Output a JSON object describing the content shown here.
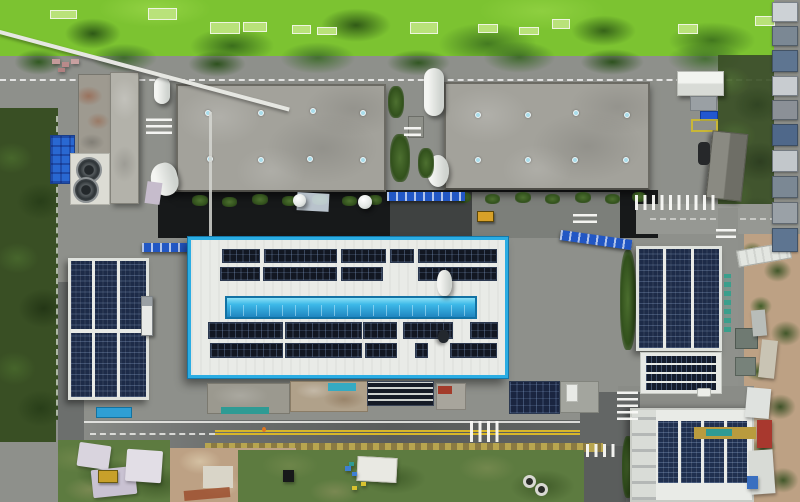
{
  "scene": {
    "type": "aerial-drone-photograph",
    "description": "Top-down aerial view of an industrial plant: two large gray warehouse roofs with blue skylight dots, a white factory hall outlined in bright cyan with a long blue skylight strip and rooftop solar arrays, three additional buildings fully covered in dark-blue solar panels, internal roads with zebra crossings and a yellow-lined perimeter road, a bright green algae pond strip along the top, dark scrub on the left edge, tan dirt lots and a weedy vacant lot along the bottom, and a column of small container buildings on the right edge",
    "time_of_day": "daytime, sunny"
  },
  "palette": {
    "asphalt": "#8e908b",
    "road_dark": "#5d605f",
    "shadow_band": "#17191a",
    "algae": "#7cc331",
    "algae_dark": "#2e571c",
    "algae_light": "#9ad84a",
    "tree": "#3c6526",
    "scrub": "#394f24",
    "warehouse_roof": "#a3a29b",
    "warehouse_edge": "#6b6a63",
    "white_roof": "#e9ebe7",
    "cyan_border": "#2bade3",
    "skylight_blue": "#a9ddeb",
    "strip_deep": "#1f85c0",
    "panel_dark": "#121722",
    "panel_blue": "#1d2b48",
    "dirt": "#bda184",
    "dirt_light": "#d8c6a8",
    "clay": "#9c4f2e",
    "lot_green": "#5d7b40",
    "yellow_line": "#d7b62a",
    "blue_tarp": "#2968d2",
    "rack_blue": "#2257c4",
    "teal": "#2f9b94"
  },
  "counts": {
    "large_warehouses": 2,
    "solar_covered_buildings": 4,
    "zebra_crossings": 8,
    "cooling_fans": 2,
    "warehouse_skylights_each": 8
  },
  "warehouse1": {
    "skylights": [
      [
        27,
        24
      ],
      [
        80,
        24
      ],
      [
        132,
        22
      ],
      [
        182,
        24
      ],
      [
        29,
        70
      ],
      [
        80,
        71
      ],
      [
        129,
        70
      ],
      [
        182,
        71
      ]
    ]
  },
  "warehouse2": {
    "skylights": [
      [
        29,
        28
      ],
      [
        79,
        28
      ],
      [
        127,
        26
      ],
      [
        178,
        28
      ],
      [
        29,
        73
      ],
      [
        79,
        73
      ],
      [
        126,
        73
      ],
      [
        177,
        73
      ]
    ]
  },
  "main_building": {
    "solar_groups": [
      [
        222,
        249,
        38,
        14
      ],
      [
        264,
        249,
        73,
        14
      ],
      [
        341,
        249,
        45,
        14
      ],
      [
        390,
        249,
        24,
        14
      ],
      [
        418,
        249,
        79,
        14
      ],
      [
        220,
        267,
        40,
        14
      ],
      [
        263,
        267,
        74,
        14
      ],
      [
        341,
        267,
        42,
        14
      ],
      [
        418,
        267,
        79,
        14
      ],
      [
        208,
        322,
        75,
        17
      ],
      [
        285,
        322,
        77,
        17
      ],
      [
        363,
        322,
        34,
        17
      ],
      [
        403,
        322,
        50,
        17
      ],
      [
        470,
        322,
        28,
        17
      ],
      [
        210,
        343,
        73,
        15
      ],
      [
        285,
        343,
        77,
        15
      ],
      [
        365,
        343,
        32,
        15
      ],
      [
        415,
        343,
        13,
        15
      ],
      [
        450,
        343,
        47,
        15
      ]
    ]
  },
  "building_h": {
    "panel_columns": [
      [
        658,
        421,
        20,
        62
      ],
      [
        681,
        421,
        20,
        62
      ],
      [
        704,
        421,
        20,
        62
      ],
      [
        727,
        421,
        20,
        62
      ]
    ]
  },
  "section_g": {
    "panel_rows": [
      [
        646,
        356,
        70,
        7
      ],
      [
        646,
        365,
        70,
        7
      ],
      [
        646,
        374,
        70,
        7
      ],
      [
        646,
        383,
        70,
        7
      ]
    ]
  },
  "ground_array_rows": [
    [
      367,
      381,
      67,
      25
    ]
  ],
  "ground_array_grid": [
    [
      509,
      381,
      51,
      33
    ]
  ],
  "algae_platforms": [
    [
      50,
      10,
      27,
      9
    ],
    [
      148,
      8,
      29,
      12
    ],
    [
      210,
      22,
      30,
      12
    ],
    [
      243,
      22,
      24,
      10
    ],
    [
      292,
      25,
      19,
      9
    ],
    [
      317,
      27,
      20,
      8
    ],
    [
      410,
      22,
      28,
      12
    ],
    [
      478,
      24,
      20,
      9
    ],
    [
      519,
      27,
      20,
      8
    ],
    [
      552,
      19,
      18,
      10
    ],
    [
      678,
      24,
      20,
      10
    ],
    [
      755,
      16,
      20,
      10
    ]
  ],
  "containers_right": [
    [
      772,
      2,
      26,
      20,
      "#cdd2d6"
    ],
    [
      772,
      26,
      26,
      20,
      "#7b8894"
    ],
    [
      772,
      50,
      26,
      22,
      "#5e7591"
    ],
    [
      772,
      76,
      26,
      20,
      "#c8ccd0"
    ],
    [
      772,
      100,
      26,
      20,
      "#8b9097"
    ],
    [
      772,
      124,
      26,
      22,
      "#4f688a"
    ],
    [
      772,
      150,
      26,
      22,
      "#c2c7cb"
    ],
    [
      772,
      176,
      26,
      22,
      "#7b8894"
    ],
    [
      772,
      202,
      26,
      22,
      "#9aa1a7"
    ],
    [
      772,
      228,
      26,
      24,
      "#5e7591"
    ]
  ],
  "shrubs": [
    [
      192,
      195,
      16,
      11
    ],
    [
      222,
      197,
      15,
      10
    ],
    [
      252,
      194,
      16,
      11
    ],
    [
      282,
      196,
      15,
      10
    ],
    [
      312,
      194,
      16,
      11
    ],
    [
      342,
      196,
      15,
      10
    ],
    [
      368,
      195,
      14,
      10
    ],
    [
      455,
      192,
      16,
      11
    ],
    [
      485,
      194,
      15,
      10
    ],
    [
      515,
      192,
      16,
      11
    ],
    [
      545,
      194,
      15,
      10
    ],
    [
      575,
      192,
      16,
      11
    ],
    [
      605,
      194,
      15,
      10
    ],
    [
      632,
      192,
      14,
      10
    ],
    [
      388,
      86,
      16,
      32
    ],
    [
      390,
      134,
      20,
      48
    ],
    [
      418,
      148,
      16,
      30
    ],
    [
      620,
      250,
      16,
      100
    ],
    [
      640,
      384,
      80,
      9
    ],
    [
      622,
      436,
      12,
      62
    ]
  ],
  "junk_right": [
    [
      752,
      310,
      14,
      26,
      "#b8bdb9",
      -5
    ],
    [
      760,
      340,
      16,
      38,
      "#c9c4b4",
      6
    ],
    [
      746,
      388,
      24,
      30,
      "#dfe2df",
      5
    ],
    [
      757,
      420,
      15,
      28,
      "#a8382e",
      0
    ],
    [
      750,
      450,
      24,
      44,
      "#d8dbd6",
      -4
    ],
    [
      747,
      476,
      11,
      13,
      "#3a6fc0",
      0
    ]
  ],
  "tarps_bottom_left": [
    [
      78,
      444,
      32,
      24,
      "#d9d4de",
      8
    ],
    [
      92,
      468,
      44,
      28,
      "#c9c2d2",
      -6
    ],
    [
      126,
      450,
      36,
      32,
      "#e2dee6",
      4
    ]
  ],
  "lot_debris": [
    [
      349,
      462,
      5,
      4,
      "#2f9b94"
    ],
    [
      345,
      466,
      6,
      5,
      "#3f7fd2"
    ],
    [
      352,
      472,
      5,
      4,
      "#3f7fd2"
    ],
    [
      352,
      486,
      5,
      4,
      "#d8c22f"
    ],
    [
      361,
      482,
      5,
      4,
      "#d8c22f"
    ],
    [
      283,
      470,
      11,
      12,
      "#17191a"
    ]
  ],
  "pink_debris": [
    [
      52,
      59,
      8,
      5,
      "#c49a9a"
    ],
    [
      62,
      62,
      7,
      5,
      "#b88a8a"
    ],
    [
      71,
      59,
      8,
      5,
      "#c8a0a0"
    ],
    [
      58,
      68,
      7,
      4,
      "#b08080"
    ]
  ]
}
